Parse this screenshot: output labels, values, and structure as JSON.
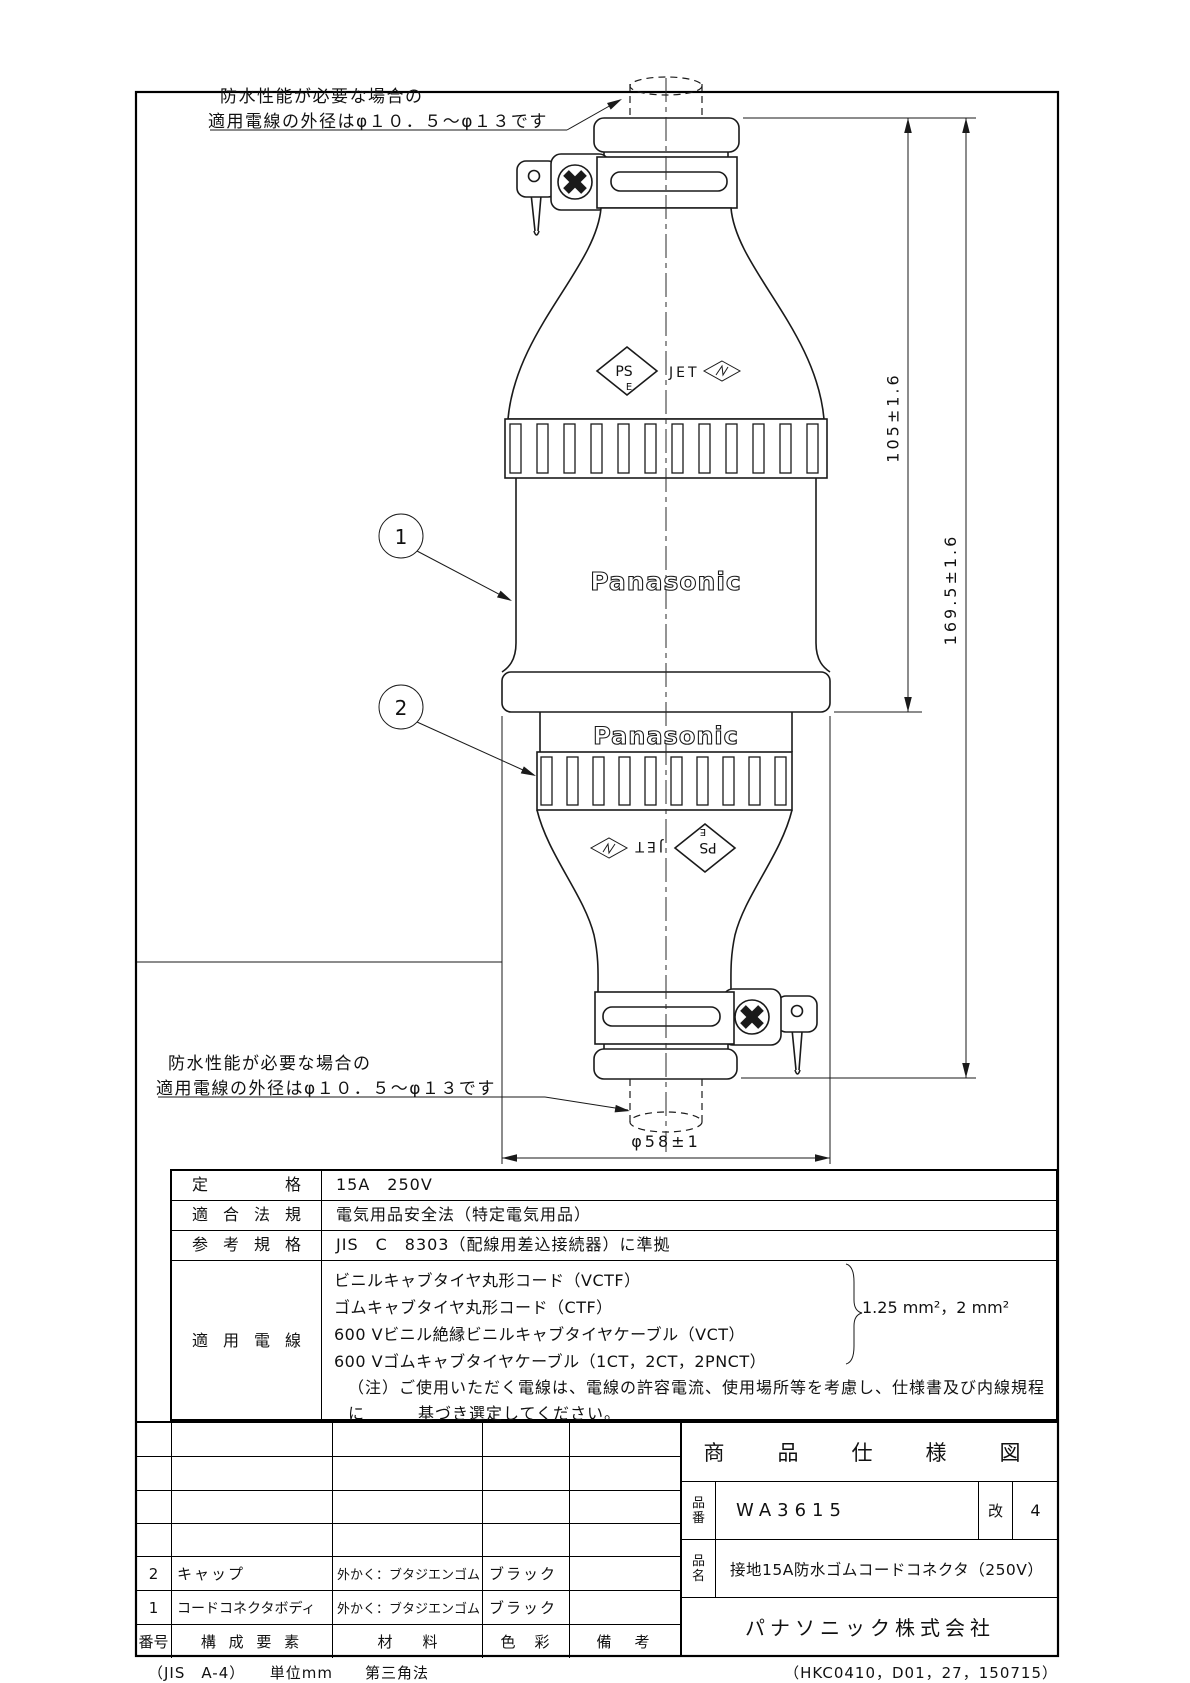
{
  "annotations": {
    "top": {
      "line1": "防水性能が必要な場合の",
      "line2": "適用電線の外径はφ１０．５〜φ１３です"
    },
    "bottom": {
      "line1": "防水性能が必要な場合の",
      "line2": "適用電線の外径はφ１０．５〜φ１３です"
    }
  },
  "drawing": {
    "brand": "Panasonic",
    "balloons": {
      "b1": "1",
      "b2": "2"
    },
    "marks": {
      "ps": "PS",
      "e": "E",
      "jet": "JET"
    },
    "dims": {
      "upper": "105±1.6",
      "total": "169.5±1.6",
      "dia": "φ58±1"
    },
    "line_color": "#1a1a1a"
  },
  "spec": {
    "rows": [
      {
        "label": "定格",
        "value": "15A　250V"
      },
      {
        "label": "適合法規",
        "value": "電気用品安全法（特定電気用品）"
      },
      {
        "label": "参考規格",
        "value": "JIS　C　8303（配線用差込接続器）に準拠"
      }
    ],
    "wires": {
      "label": "適用電線",
      "lines": [
        "ビニルキャブタイヤ丸形コード（VCTF）",
        "ゴムキャブタイヤ丸形コード（CTF）",
        "600 Vビニル絶縁ビニルキャブタイヤケーブル（VCT）",
        "600 Vゴムキャブタイヤケーブル（1CT，2CT，2PNCT）"
      ],
      "size_note": "1.25 mm²，2 mm²",
      "note1": "（注）ご使用いただく電線は、電線の許容電流、使用場所等を考慮し、仕様書及び内線規程に",
      "note2": "基づき選定してください。"
    }
  },
  "parts": {
    "header": {
      "no": "番号",
      "name": "構 成 要 素",
      "material": "材　　料",
      "color": "色　彩",
      "remark": "備　考"
    },
    "rows": [
      {
        "no": "2",
        "name": "キャップ",
        "material": "外かく：ブタジエンゴム",
        "color": "ブラック",
        "remark": ""
      },
      {
        "no": "1",
        "name": "コードコネクタボディ",
        "material": "外かく：ブタジエンゴム",
        "color": "ブラック",
        "remark": ""
      }
    ]
  },
  "title_block": {
    "title": "商　品　仕　様　図",
    "part_no_label": "品番",
    "part_no": "WA3615",
    "rev_label": "改",
    "rev": "4",
    "part_name_label": "品名",
    "part_name": "接地15A防水ゴムコードコネクタ（250V）",
    "company": "パナソニック株式会社"
  },
  "footer": {
    "left": "（JIS　A-4）　　単位mm　　第三角法",
    "right": "（HKC0410，D01，27，150715）"
  }
}
